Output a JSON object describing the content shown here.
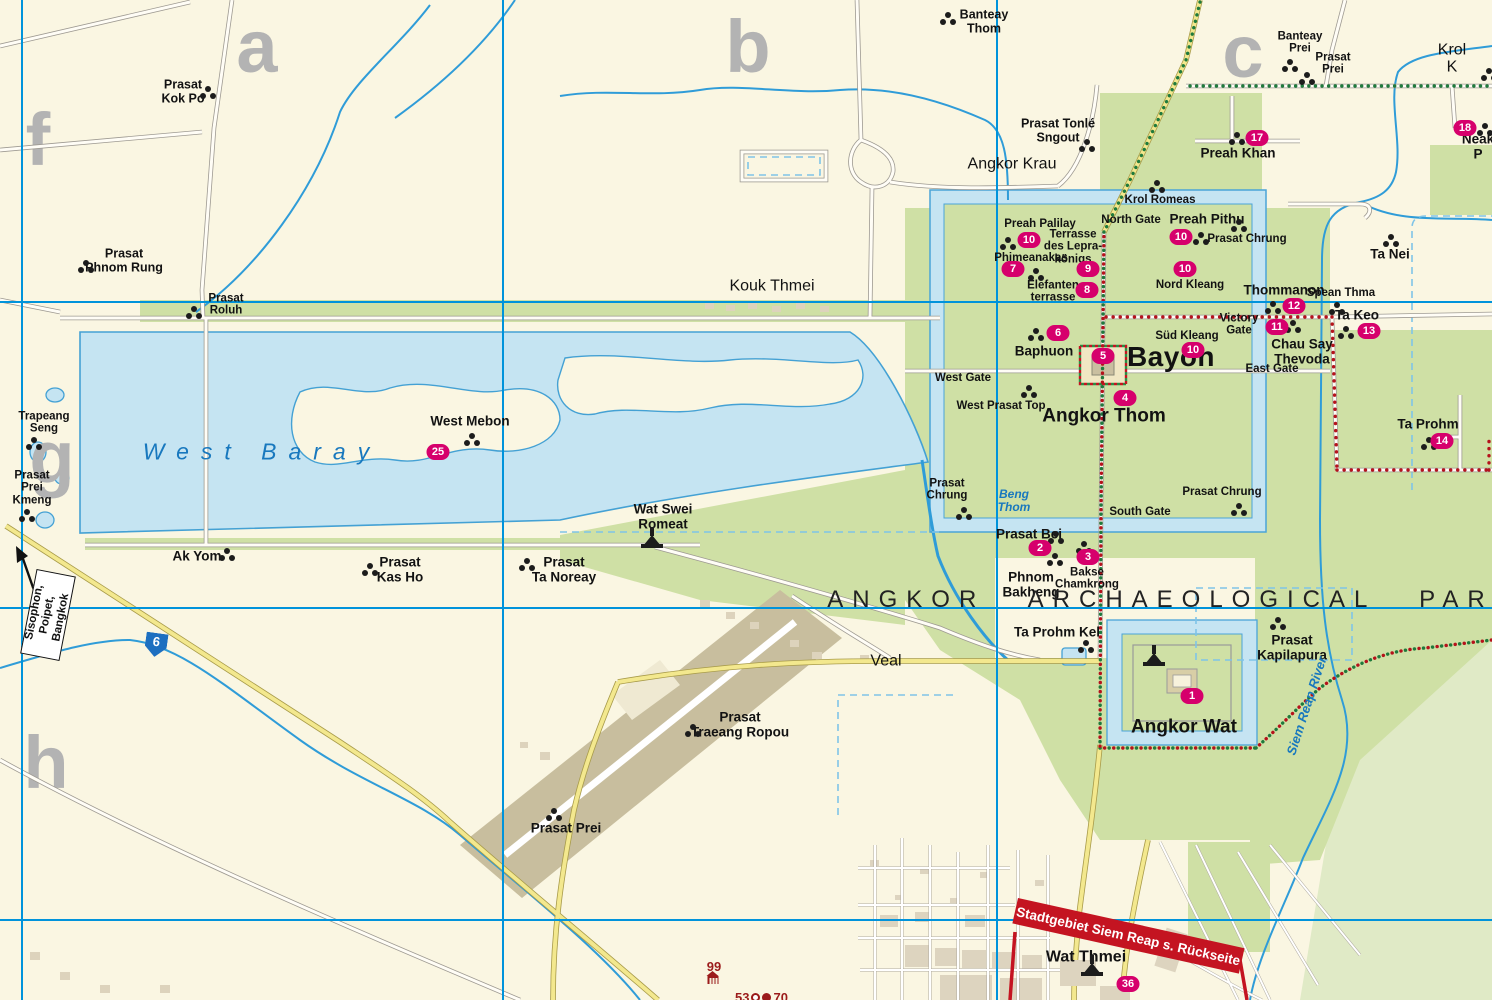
{
  "map": {
    "park_title": "ANGKOR ARCHAEOLOGICAL PARK",
    "banner_text": "Stadtgebiet Siem Reap s. Rückseite",
    "route_shield": "6",
    "direction_sign": "Sisophon,\nPoipet, Bangkok",
    "colors": {
      "background": "#FAF6E2",
      "park_green": "#CFE0A5",
      "water_fill": "#C5E4F2",
      "water_line": "#2F9CD8",
      "grid_blue": "#0093DB",
      "road_yellow": "#F3E88E",
      "badge_magenta": "#D6006C",
      "banner_red": "#C41421",
      "trail_red": "#B5121B",
      "trail_green": "#1F7A3C",
      "airport_tan": "#C8BE9E",
      "letter_gray": "#B3B3B3"
    }
  },
  "grid_letters": [
    {
      "id": "a",
      "label": "a",
      "x": 257,
      "y": 47
    },
    {
      "id": "b",
      "label": "b",
      "x": 748,
      "y": 47
    },
    {
      "id": "c",
      "label": "c",
      "x": 1243,
      "y": 52
    },
    {
      "id": "f",
      "label": "f",
      "x": 38,
      "y": 140
    },
    {
      "id": "g",
      "label": "g",
      "x": 52,
      "y": 458
    },
    {
      "id": "h",
      "label": "h",
      "x": 46,
      "y": 763
    }
  ],
  "places": [
    {
      "id": "prasat-kok-po",
      "label": "Prasat\nKok Po",
      "x": 183,
      "y": 92,
      "cls": "lbl-m",
      "icon": "temple",
      "ix": 208,
      "iy": 92
    },
    {
      "id": "prasat-phnom-rung",
      "label": "Prasat\nPhnom Rung",
      "x": 124,
      "y": 261,
      "cls": "lbl-m",
      "icon": "temple",
      "ix": 86,
      "iy": 266
    },
    {
      "id": "prasat-roluh",
      "label": "Prasat\nRoluh",
      "x": 226,
      "y": 305,
      "cls": "lbl-s",
      "icon": "temple",
      "ix": 194,
      "iy": 312
    },
    {
      "id": "banteay-thom",
      "label": "Banteay\nThom",
      "x": 984,
      "y": 22,
      "cls": "lbl-m",
      "icon": "temple",
      "ix": 948,
      "iy": 18
    },
    {
      "id": "prasat-tonle-sngout",
      "label": "Prasat Tonlé\nSngout",
      "x": 1058,
      "y": 131,
      "cls": "lbl-m",
      "icon": "temple",
      "ix": 1087,
      "iy": 145
    },
    {
      "id": "angkor-krau",
      "label": "Angkor Krau",
      "x": 1012,
      "y": 164,
      "cls": "lbl-lg"
    },
    {
      "id": "kouk-thmei",
      "label": "Kouk Thmei",
      "x": 772,
      "y": 286,
      "cls": "lbl-lg"
    },
    {
      "id": "banteay-prei",
      "label": "Banteay\nPrei",
      "x": 1300,
      "y": 43,
      "cls": "lbl-s",
      "icon": "temple",
      "ix": 1290,
      "iy": 65
    },
    {
      "id": "prasat-prei-ne",
      "label": "Prasat\nPrei",
      "x": 1333,
      "y": 64,
      "cls": "lbl-s",
      "icon": "temple",
      "ix": 1307,
      "iy": 78
    },
    {
      "id": "krol-ko",
      "label": "Krol K",
      "x": 1452,
      "y": 59,
      "cls": "lbl-lg",
      "icon": "temple",
      "ix": 1489,
      "iy": 74
    },
    {
      "id": "preah-khan",
      "label": "Preah Khan",
      "x": 1238,
      "y": 154,
      "cls": "lbl-mb",
      "icon": "temple",
      "ix": 1237,
      "iy": 138,
      "badge": "17",
      "bx": 1257,
      "by": 138
    },
    {
      "id": "krol-romeas",
      "label": "Krol Romeas",
      "x": 1160,
      "y": 200,
      "cls": "lbl-s",
      "icon": "temple",
      "ix": 1157,
      "iy": 186
    },
    {
      "id": "north-gate",
      "label": "North Gate",
      "x": 1131,
      "y": 220,
      "cls": "lbl-s"
    },
    {
      "id": "preah-pithu",
      "label": "Preah Pithu",
      "x": 1207,
      "y": 220,
      "cls": "lbl-mb",
      "icon": "temple",
      "ix": 1201,
      "iy": 238,
      "badge": "10",
      "bx": 1181,
      "by": 237
    },
    {
      "id": "prasat-chrung-ne",
      "label": "Prasat Chrung",
      "x": 1247,
      "y": 239,
      "cls": "lbl-s",
      "icon": "temple",
      "ix": 1239,
      "iy": 225
    },
    {
      "id": "ta-nei",
      "label": "Ta Nei",
      "x": 1390,
      "y": 255,
      "cls": "lbl-mb",
      "icon": "temple",
      "ix": 1391,
      "iy": 240
    },
    {
      "id": "preah-palilay",
      "label": "Preah Palilay",
      "x": 1040,
      "y": 224,
      "cls": "lbl-s",
      "icon": "temple",
      "ix": 1008,
      "iy": 243,
      "badge": "10",
      "bx": 1029,
      "by": 240
    },
    {
      "id": "terrasse-lepra",
      "label": "Terrasse\ndes Lepra-\nkönigs",
      "x": 1073,
      "y": 247,
      "cls": "lbl-s",
      "badge": "9",
      "bx": 1088,
      "by": 269
    },
    {
      "id": "phimeanakas",
      "label": "Phimeanakas",
      "x": 1031,
      "y": 258,
      "cls": "lbl-s",
      "icon": "temple",
      "ix": 1036,
      "iy": 274,
      "badge": "7",
      "bx": 1013,
      "by": 269
    },
    {
      "id": "elefanten-terrasse",
      "label": "Elefanten\nterrasse",
      "x": 1053,
      "y": 292,
      "cls": "lbl-s",
      "badge": "8",
      "bx": 1087,
      "by": 290
    },
    {
      "id": "nord-kleang",
      "label": "Nord Kleang",
      "x": 1190,
      "y": 285,
      "cls": "lbl-s",
      "badge": "10",
      "bx": 1185,
      "by": 269
    },
    {
      "id": "thommanon",
      "label": "Thommanon",
      "x": 1284,
      "y": 291,
      "cls": "lbl-mb",
      "icon": "temple",
      "ix": 1273,
      "iy": 307,
      "badge": "12",
      "bx": 1294,
      "by": 306
    },
    {
      "id": "spean-thma",
      "label": "Spean Thma",
      "x": 1341,
      "y": 293,
      "cls": "lbl-s",
      "icon": "temple",
      "ix": 1337,
      "iy": 308
    },
    {
      "id": "victory-gate",
      "label": "Victory\nGate",
      "x": 1239,
      "y": 325,
      "cls": "lbl-s"
    },
    {
      "id": "chau-say-thevoda",
      "label": "Chau Say\nThevoda",
      "x": 1302,
      "y": 352,
      "cls": "lbl-mb",
      "icon": "temple",
      "ix": 1293,
      "iy": 326,
      "badge": "11",
      "bx": 1277,
      "by": 327
    },
    {
      "id": "ta-keo",
      "label": "Ta Keo",
      "x": 1357,
      "y": 316,
      "cls": "lbl-mb",
      "icon": "temple",
      "ix": 1346,
      "iy": 332,
      "badge": "13",
      "bx": 1369,
      "by": 331
    },
    {
      "id": "sued-kleang",
      "label": "Süd Kleang",
      "x": 1187,
      "y": 336,
      "cls": "lbl-s",
      "badge": "10",
      "bx": 1193,
      "by": 350
    },
    {
      "id": "baphuon",
      "label": "Baphuon",
      "x": 1044,
      "y": 352,
      "cls": "lbl-mb",
      "icon": "temple",
      "ix": 1036,
      "iy": 334,
      "badge": "6",
      "bx": 1058,
      "by": 333
    },
    {
      "id": "bayon",
      "label": "Bayon",
      "x": 1171,
      "y": 357,
      "cls": "lbl-xl",
      "badge": "5",
      "bx": 1103,
      "by": 356
    },
    {
      "id": "east-gate",
      "label": "East Gate",
      "x": 1272,
      "y": 369,
      "cls": "lbl-s"
    },
    {
      "id": "west-gate",
      "label": "West Gate",
      "x": 963,
      "y": 378,
      "cls": "lbl-s"
    },
    {
      "id": "west-prasat-top",
      "label": "West Prasat Top",
      "x": 1001,
      "y": 406,
      "cls": "lbl-s",
      "icon": "temple",
      "ix": 1029,
      "iy": 391
    },
    {
      "id": "angkor-thom",
      "label": "Angkor Thom",
      "x": 1104,
      "y": 417,
      "cls": "lbl-xl2",
      "badge": "4",
      "bx": 1125,
      "by": 398
    },
    {
      "id": "ta-prohm",
      "label": "Ta Prohm",
      "x": 1428,
      "y": 425,
      "cls": "lbl-mb",
      "icon": "temple",
      "ix": 1429,
      "iy": 443,
      "badge": "14",
      "bx": 1442,
      "by": 441
    },
    {
      "id": "prasat-chrung-sw",
      "label": "Prasat\nChrung",
      "x": 947,
      "y": 490,
      "cls": "lbl-s",
      "icon": "temple",
      "ix": 964,
      "iy": 513
    },
    {
      "id": "beng-thom",
      "label": "Beng\nThom",
      "x": 1014,
      "y": 501,
      "cls": "lbl-water-s"
    },
    {
      "id": "prasat-chrung-se",
      "label": "Prasat Chrung",
      "x": 1222,
      "y": 492,
      "cls": "lbl-s",
      "icon": "temple",
      "ix": 1239,
      "iy": 509
    },
    {
      "id": "south-gate",
      "label": "South Gate",
      "x": 1140,
      "y": 512,
      "cls": "lbl-s"
    },
    {
      "id": "prasat-bei",
      "label": "Prasat Bei",
      "x": 1029,
      "y": 535,
      "cls": "lbl-mb",
      "icon": "temple",
      "ix": 1056,
      "iy": 537
    },
    {
      "id": "phnom-bakheng",
      "label": "Phnom\nBakheng",
      "x": 1031,
      "y": 585,
      "cls": "lbl-mb",
      "icon": "temple",
      "ix": 1055,
      "iy": 559,
      "badge": "2",
      "bx": 1040,
      "by": 548
    },
    {
      "id": "bakse-chamkrong",
      "label": "Bakse\nChamkrong",
      "x": 1087,
      "y": 579,
      "cls": "lbl-s",
      "icon": "temple",
      "ix": 1084,
      "iy": 547,
      "badge": "3",
      "bx": 1088,
      "by": 557
    },
    {
      "id": "trapeang-seng",
      "label": "Trapeang\nSeng",
      "x": 44,
      "y": 423,
      "cls": "lbl-s",
      "icon": "temple",
      "ix": 34,
      "iy": 443
    },
    {
      "id": "prasat-prei-kmeng",
      "label": "Prasat\nPrei\nKmeng",
      "x": 32,
      "y": 488,
      "cls": "lbl-s",
      "icon": "temple",
      "ix": 27,
      "iy": 515
    },
    {
      "id": "west-baray",
      "label": "West Baray",
      "x": 262,
      "y": 452,
      "cls": "lbl-water-xl"
    },
    {
      "id": "west-mebon",
      "label": "West Mebon",
      "x": 470,
      "y": 422,
      "cls": "lbl-mb",
      "icon": "temple",
      "ix": 472,
      "iy": 439,
      "badge": "25",
      "bx": 438,
      "by": 452
    },
    {
      "id": "ak-yom",
      "label": "Ak Yom",
      "x": 197,
      "y": 557,
      "cls": "lbl-mb",
      "icon": "temple",
      "ix": 227,
      "iy": 554
    },
    {
      "id": "prasat-kas-ho",
      "label": "Prasat\nKas Ho",
      "x": 400,
      "y": 570,
      "cls": "lbl-mb",
      "icon": "temple",
      "ix": 370,
      "iy": 569
    },
    {
      "id": "prasat-ta-noreay",
      "label": "Prasat\nTa Noreay",
      "x": 564,
      "y": 570,
      "cls": "lbl-mb",
      "icon": "temple",
      "ix": 527,
      "iy": 564
    },
    {
      "id": "wat-swei-romeat",
      "label": "Wat Swei\nRomeat",
      "x": 663,
      "y": 517,
      "cls": "lbl-mb",
      "icon": "pagoda",
      "ix": 652,
      "iy": 540
    },
    {
      "id": "veal",
      "label": "Veal",
      "x": 886,
      "y": 661,
      "cls": "lbl-lg"
    },
    {
      "id": "prasat-traeang-ropou",
      "label": "Prasat\nTraeang Ropou",
      "x": 740,
      "y": 725,
      "cls": "lbl-mb",
      "icon": "temple",
      "ix": 693,
      "iy": 730
    },
    {
      "id": "prasat-prei-s",
      "label": "Prasat Prei",
      "x": 566,
      "y": 829,
      "cls": "lbl-mb",
      "icon": "temple",
      "ix": 554,
      "iy": 814
    },
    {
      "id": "ta-prohm-kel",
      "label": "Ta Prohm Kel",
      "x": 1057,
      "y": 633,
      "cls": "lbl-mb",
      "icon": "temple",
      "ix": 1086,
      "iy": 646
    },
    {
      "id": "prasat-kapilapura",
      "label": "Prasat\nKapilapura",
      "x": 1292,
      "y": 648,
      "cls": "lbl-mb",
      "icon": "temple",
      "ix": 1278,
      "iy": 623
    },
    {
      "id": "angkor-wat",
      "label": "Angkor Wat",
      "x": 1184,
      "y": 728,
      "cls": "lbl-xl2",
      "icon": "pagoda",
      "ix": 1154,
      "iy": 658,
      "badge": "1",
      "bx": 1192,
      "by": 696
    },
    {
      "id": "neak-pean",
      "label": "Neak P",
      "x": 1478,
      "y": 147,
      "cls": "lbl-mb",
      "icon": "temple",
      "ix": 1485,
      "iy": 129,
      "badge": "18",
      "bx": 1465,
      "by": 128
    },
    {
      "id": "wat-thmei",
      "label": "Wat Thmei",
      "x": 1086,
      "y": 957,
      "cls": "lbl-lgb",
      "icon": "pagoda",
      "ix": 1092,
      "iy": 968,
      "badge": "36",
      "bx": 1128,
      "by": 984
    },
    {
      "id": "siem-reap-river",
      "label": "Siem Reap River",
      "x": 1307,
      "y": 706,
      "cls": "lbl-water-r",
      "rot": -72
    },
    {
      "id": "park-title",
      "label": "ANGKOR ARCHAEOLOGICAL PARK",
      "x": 1173,
      "y": 600,
      "cls": "lbl-park"
    },
    {
      "id": "poi-99",
      "label": "99",
      "x": 714,
      "y": 967,
      "cls": "red-num"
    }
  ],
  "poi_numbers": {
    "n99": "99",
    "n53": "53",
    "n70": "70"
  }
}
